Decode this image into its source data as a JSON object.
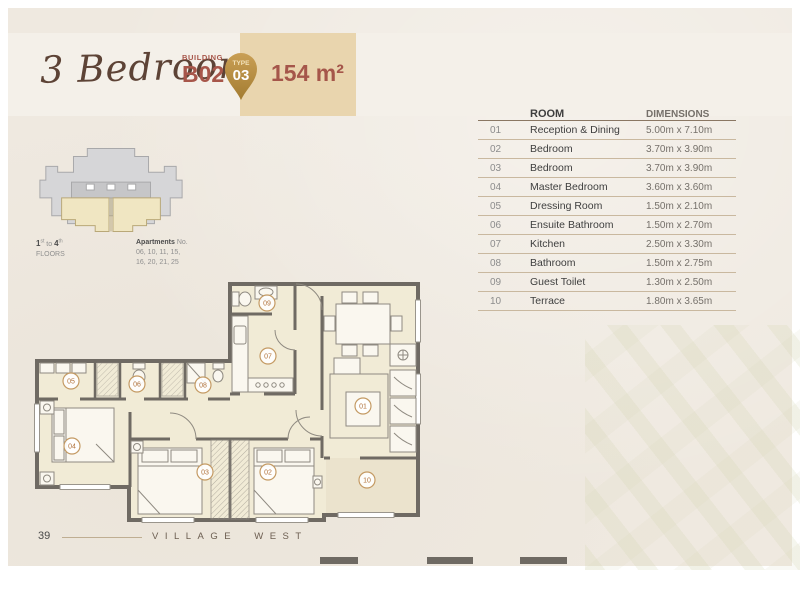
{
  "header": {
    "title": "3 Bedroom",
    "building_label": "BUILDING",
    "building_value": "B02",
    "badge_label": "TYPE",
    "badge_value": "03",
    "area_value": "154 m²"
  },
  "key_plan": {
    "floors": {
      "n1": "1",
      "sup1": "st",
      "to": " to ",
      "n2": "4",
      "sup2": "th",
      "label": "FLOORS"
    },
    "apartments_label": "Apartments",
    "apartments_no": " No.",
    "apartments_line1": "06, 10, 11, 15,",
    "apartments_line2": "16, 20, 21, 25"
  },
  "dimensions_table": {
    "columns": {
      "room": "ROOM",
      "dimensions": "DIMENSIONS"
    },
    "rows": [
      {
        "no": "01",
        "room": "Reception & Dining",
        "dim": "5.00m x 7.10m"
      },
      {
        "no": "02",
        "room": "Bedroom",
        "dim": "3.70m x 3.90m"
      },
      {
        "no": "03",
        "room": "Bedroom",
        "dim": "3.70m x 3.90m"
      },
      {
        "no": "04",
        "room": "Master Bedroom",
        "dim": "3.60m x 3.60m"
      },
      {
        "no": "05",
        "room": "Dressing Room",
        "dim": "1.50m x 2.10m"
      },
      {
        "no": "06",
        "room": "Ensuite Bathroom",
        "dim": "1.50m x 2.70m"
      },
      {
        "no": "07",
        "room": "Kitchen",
        "dim": "2.50m x 3.30m"
      },
      {
        "no": "08",
        "room": "Bathroom",
        "dim": "1.50m x 2.75m"
      },
      {
        "no": "09",
        "room": "Guest Toilet",
        "dim": "1.30m x 2.50m"
      },
      {
        "no": "10",
        "room": "Terrace",
        "dim": "1.80m x 3.65m"
      }
    ]
  },
  "floor_plan": {
    "room_labels": [
      {
        "no": "01"
      },
      {
        "no": "02"
      },
      {
        "no": "03"
      },
      {
        "no": "04"
      },
      {
        "no": "05"
      },
      {
        "no": "06"
      },
      {
        "no": "07"
      },
      {
        "no": "08"
      },
      {
        "no": "09"
      },
      {
        "no": "10"
      }
    ]
  },
  "footer": {
    "page_number": "39",
    "project_name": "VILLAGE WEST"
  },
  "colors": {
    "page_cream": "#efe9e0",
    "header_band": "#f4f0e9",
    "accent_tan": "#e9d5ae",
    "badge_gold": "#b8903f",
    "title_brown": "#5d4336",
    "red_brown": "#a5564a",
    "wall_gray": "#6f6a63",
    "room_fill": "#f1ebd6",
    "terrace_fill": "#ebe3cd",
    "circle_stroke": "#c49a63",
    "circle_text": "#b0713a"
  }
}
